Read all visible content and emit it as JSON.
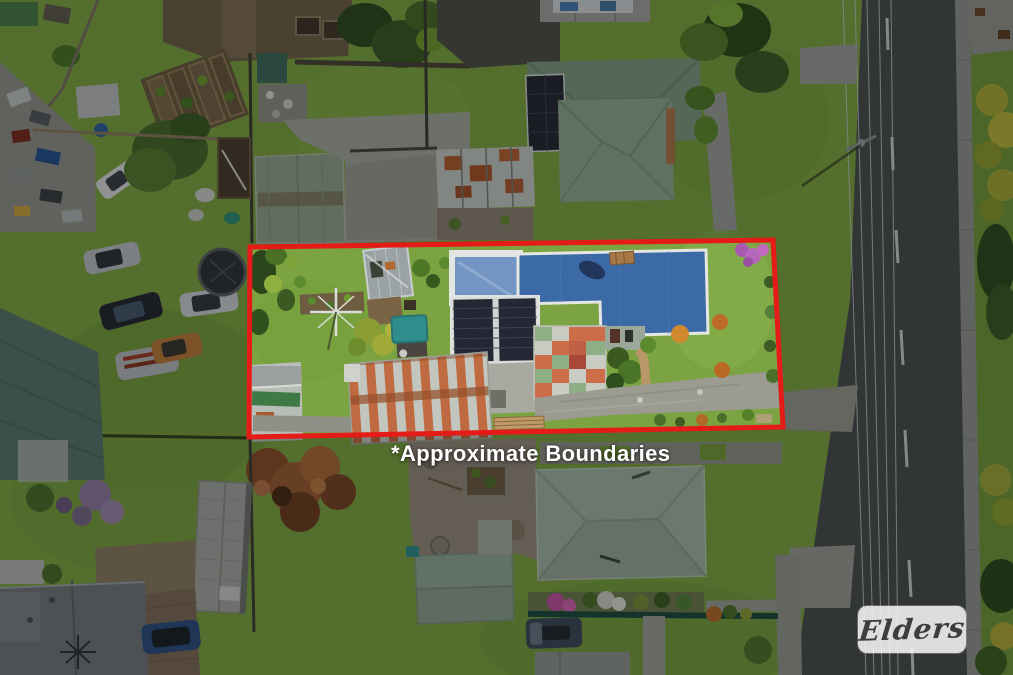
{
  "photo": {
    "kind": "aerial-drone-photo",
    "subject": "residential property outlined in red"
  },
  "overlay": {
    "watermark_label": "*Approximate Boundaries",
    "brand_name": "Elders"
  },
  "palette": {
    "boundary_red": "#e51b18",
    "watermark_text": "#ffffff",
    "logo_bg": "rgba(246,245,242,0.88)",
    "logo_text": "#3d3d3d",
    "grass_bright": "#7ca341",
    "road_asphalt": "#4a4c4e",
    "roof_blue": "#3c6aa6",
    "roof_solar": "#232834",
    "roof_green_north": "#7e9a80",
    "roof_green_south": "#9fb2a2",
    "shed_orange": "#bf6a40"
  }
}
